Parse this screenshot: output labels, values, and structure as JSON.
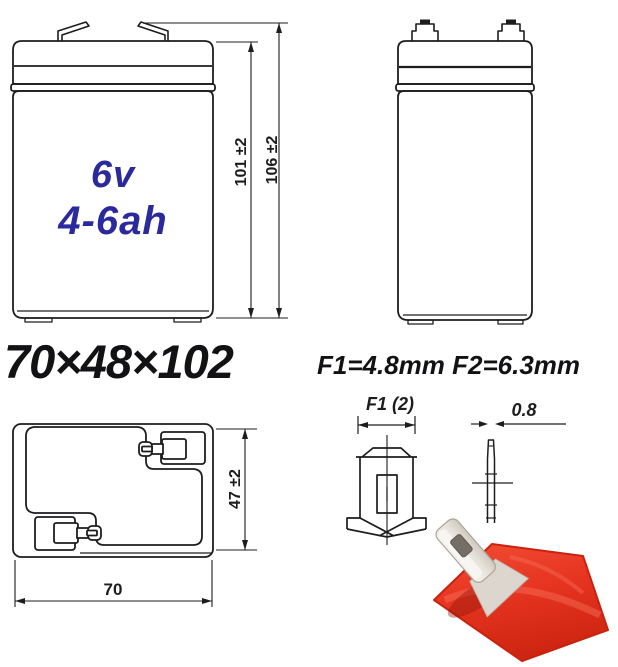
{
  "sheet": {
    "kind": "battery dimensional drawing"
  },
  "front_view": {
    "capacity_line1": "6v",
    "capacity_line2": "4-6ah",
    "dim_inner_height": "101 ±2",
    "dim_total_height": "106 ±2"
  },
  "summary": {
    "overall_size": "70×48×102"
  },
  "terminal_spec": {
    "text": "F1=4.8mm F2=6.3mm"
  },
  "top_view": {
    "dim_depth": "47 ±2",
    "dim_width": "70"
  },
  "terminal_front_detail": {
    "dim_label": "F1 (2)"
  },
  "terminal_side_detail": {
    "dim_label": "0.8"
  },
  "colors": {
    "line": "#1d1d1f",
    "capacity_blue": "#2a2a9e",
    "terminal_base_red": "#e63420",
    "terminal_metal": "#ece8e1"
  }
}
